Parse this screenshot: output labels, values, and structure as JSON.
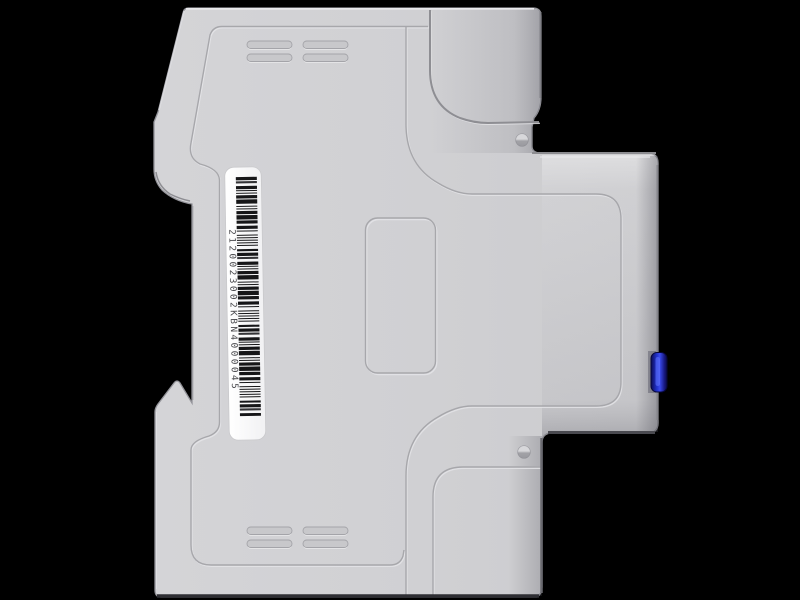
{
  "scene": {
    "object": "din-rail-module-side-view",
    "background_color": "#000000",
    "body_color": "#d0d0d3",
    "button_color": "#2030c8",
    "label_color": "#fcfcfd"
  },
  "label": {
    "serial": "2120023002KBN4000045"
  }
}
